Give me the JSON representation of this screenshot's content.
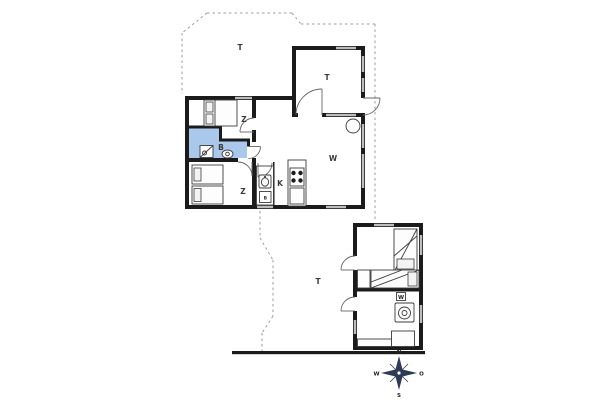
{
  "colors": {
    "bg": "#ffffff",
    "wall": "#1b1b1b",
    "win": "#bdbdbd",
    "bath": "#aac8ec",
    "dash": "#9e9e9e",
    "compass": "#2e3b57"
  },
  "rooms": {
    "terrace_top_label": "T",
    "conservatory_label": "T",
    "bedroom1_label": "Z",
    "bedroom2_label": "Z",
    "bathroom_label": "B",
    "kitchen_label": "K",
    "living_label": "W",
    "counter_appliance_label": "B",
    "terrace_lower_label": "T",
    "annex_utility_label": "W"
  },
  "compass": {
    "north": "N",
    "east": "O",
    "south": "S",
    "west": "W"
  }
}
